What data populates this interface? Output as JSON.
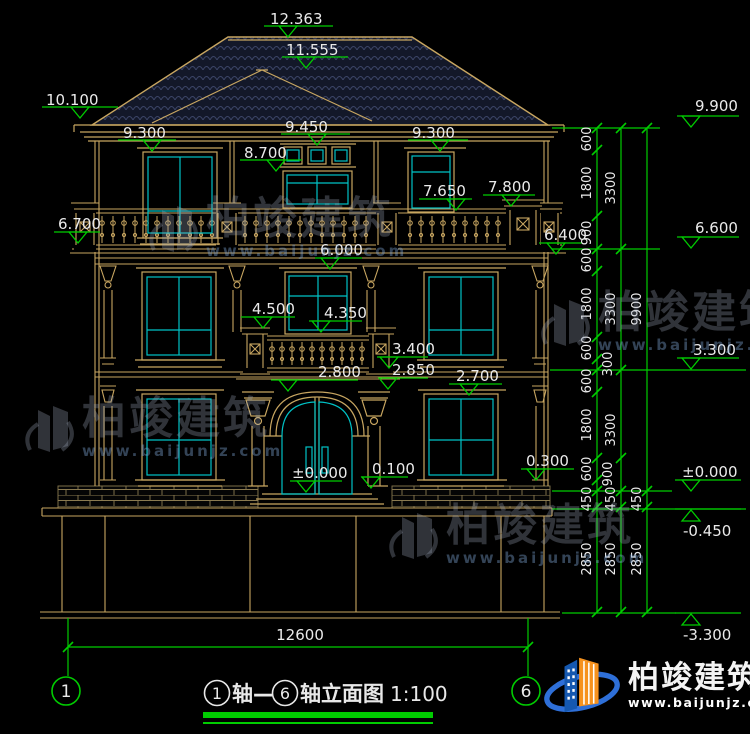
{
  "drawing": {
    "colors": {
      "line": "#c8a661",
      "glass": "#00c2c6",
      "dim": "#00cc00",
      "text": "#eaeaea",
      "roof_bg": "#131829",
      "roof_tile": "#3b4466"
    },
    "title": {
      "axis_a": "1",
      "joiner": "轴—",
      "axis_b": "6",
      "suffix": "轴立面图",
      "scale": "1:100"
    },
    "axis_bubbles": [
      {
        "label": "1",
        "cx": 66,
        "cy": 691,
        "lx": 68
      },
      {
        "label": "6",
        "cx": 526,
        "cy": 691,
        "lx": 528
      }
    ],
    "levels": [
      {
        "label": "12.363",
        "tx": 270,
        "ty": 12,
        "x1": 264,
        "x2": 333,
        "ly": 26,
        "cx": 288,
        "dir": "down"
      },
      {
        "label": "11.555",
        "tx": 286,
        "ty": 43,
        "x1": 282,
        "x2": 348,
        "ly": 57,
        "cx": 306,
        "dir": "down"
      },
      {
        "label": "10.100",
        "tx": 46,
        "ty": 93,
        "x1": 42,
        "x2": 118,
        "ly": 107,
        "cx": 80,
        "dir": "down"
      },
      {
        "label": "9.300",
        "tx": 123,
        "ty": 126,
        "x1": 118,
        "x2": 176,
        "ly": 140,
        "cx": 152,
        "dir": "down"
      },
      {
        "label": "9.450",
        "tx": 285,
        "ty": 120,
        "x1": 281,
        "x2": 350,
        "ly": 134,
        "cx": 317,
        "dir": "down"
      },
      {
        "label": "9.300",
        "tx": 412,
        "ty": 126,
        "x1": 408,
        "x2": 468,
        "ly": 140,
        "cx": 440,
        "dir": "down"
      },
      {
        "label": "8.700",
        "tx": 244,
        "ty": 146,
        "x1": 240,
        "x2": 302,
        "ly": 160,
        "cx": 276,
        "dir": "down"
      },
      {
        "label": "7.650",
        "tx": 423,
        "ty": 184,
        "x1": 419,
        "x2": 472,
        "ly": 199,
        "cx": 456,
        "dir": "down"
      },
      {
        "label": "7.800",
        "tx": 488,
        "ty": 180,
        "x1": 483,
        "x2": 535,
        "ly": 195,
        "cx": 511,
        "dir": "down"
      },
      {
        "label": "6.700",
        "tx": 58,
        "ty": 217,
        "x1": 54,
        "x2": 100,
        "ly": 232,
        "cx": 78,
        "dir": "down"
      },
      {
        "label": "6.400",
        "tx": 544,
        "ty": 228,
        "x1": 539,
        "x2": 582,
        "ly": 243,
        "cx": 556,
        "dir": "down"
      },
      {
        "label": "6.000",
        "tx": 320,
        "ty": 243,
        "x1": 315,
        "x2": 362,
        "ly": 258,
        "cx": 330,
        "dir": "down"
      },
      {
        "label": "4.500",
        "tx": 252,
        "ty": 302,
        "x1": 241,
        "x2": 295,
        "ly": 317,
        "cx": 263,
        "dir": "down"
      },
      {
        "label": "4.350",
        "tx": 324,
        "ty": 306,
        "x1": 309,
        "x2": 362,
        "ly": 321,
        "cx": 321,
        "dir": "down"
      },
      {
        "label": "3.400",
        "tx": 392,
        "ty": 342,
        "x1": 377,
        "x2": 428,
        "ly": 357,
        "cx": 389,
        "dir": "down"
      },
      {
        "label": "2.850",
        "tx": 392,
        "ty": 363,
        "x1": 382,
        "x2": 428,
        "ly": 378,
        "cx": 388,
        "dir": "down"
      },
      {
        "label": "2.800",
        "tx": 318,
        "ty": 365,
        "x1": 271,
        "x2": 358,
        "ly": 380,
        "cx": 288,
        "dir": "down"
      },
      {
        "label": "2.700",
        "tx": 456,
        "ty": 369,
        "x1": 449,
        "x2": 502,
        "ly": 384,
        "cx": 469,
        "dir": "down"
      },
      {
        "label": "±0.000",
        "tx": 292,
        "ty": 466,
        "x1": 290,
        "x2": 342,
        "ly": 481,
        "cx": 306,
        "dir": "down"
      },
      {
        "label": "0.100",
        "tx": 372,
        "ty": 462,
        "x1": 361,
        "x2": 408,
        "ly": 477,
        "cx": 371,
        "dir": "down"
      },
      {
        "label": "0.300",
        "tx": 526,
        "ty": 454,
        "x1": 521,
        "x2": 574,
        "ly": 469,
        "cx": 536,
        "dir": "down"
      },
      {
        "label": "9.900",
        "tx": 695,
        "ty": 99,
        "x1": 677,
        "x2": 739,
        "ly": 116,
        "cx": 691,
        "dir": "down"
      },
      {
        "label": "6.600",
        "tx": 695,
        "ty": 221,
        "x1": 677,
        "x2": 739,
        "ly": 237,
        "cx": 691,
        "dir": "down"
      },
      {
        "label": "3.300",
        "tx": 693,
        "ty": 343,
        "x1": 677,
        "x2": 739,
        "ly": 358,
        "cx": 691,
        "dir": "down"
      },
      {
        "label": "±0.000",
        "tx": 682,
        "ty": 465,
        "x1": 675,
        "x2": 741,
        "ly": 480,
        "cx": 691,
        "dir": "down"
      },
      {
        "label": "-0.450",
        "tx": 683,
        "ty": 524,
        "x1": 675,
        "x2": 741,
        "ly": 509,
        "cx": 691,
        "dir": "up"
      },
      {
        "label": "-3.300",
        "tx": 683,
        "ty": 628,
        "x1": 675,
        "x2": 741,
        "ly": 613,
        "cx": 691,
        "dir": "up"
      }
    ],
    "dim_chain": {
      "columns": [
        {
          "x": 597,
          "ticks": [
            128,
            150,
            216,
            249,
            271,
            337,
            359,
            370,
            392,
            458,
            480,
            491,
            507,
            612
          ],
          "labels": [
            {
              "v": "600",
              "y": 139
            },
            {
              "v": "1800",
              "y": 183
            },
            {
              "v": "900",
              "y": 233
            },
            {
              "v": "600",
              "y": 260
            },
            {
              "v": "1800",
              "y": 304
            },
            {
              "v": "600",
              "y": 348
            },
            {
              "v": "600",
              "y": 381
            },
            {
              "v": "1800",
              "y": 425
            },
            {
              "v": "600",
              "y": 469
            },
            {
              "v": "450",
              "y": 499
            },
            {
              "v": "2850",
              "y": 559
            }
          ]
        },
        {
          "x": 621,
          "ticks": [
            128,
            249,
            370,
            458,
            491,
            507,
            612
          ],
          "labels": [
            {
              "v": "3300",
              "y": 188
            },
            {
              "v": "3300",
              "y": 309
            },
            {
              "v": "3300",
              "y": 430
            },
            {
              "v": "450",
              "y": 499
            },
            {
              "v": "2850",
              "y": 559
            }
          ]
        },
        {
          "x": 647,
          "ticks": [
            128,
            491,
            507,
            612
          ],
          "labels": [
            {
              "v": "9900",
              "y": 309
            },
            {
              "v": "450",
              "y": 499
            },
            {
              "v": "2850",
              "y": 559
            }
          ]
        }
      ],
      "floating_labels": [
        {
          "v": "300",
          "x": 612,
          "y": 364
        },
        {
          "v": "900",
          "x": 612,
          "y": 474
        }
      ]
    },
    "bottom_dim": {
      "label": "12600",
      "x1": 68,
      "x2": 528,
      "y": 647,
      "tx": 300,
      "ty": 640
    }
  },
  "watermarks": {
    "name": "柏竣建筑",
    "url": "www.baijunjz.com",
    "positions": [
      {
        "x": 146,
        "y": 196
      },
      {
        "x": 538,
        "y": 290
      },
      {
        "x": 22,
        "y": 396
      },
      {
        "x": 386,
        "y": 503
      }
    ]
  },
  "brand": {
    "name": "柏竣建筑",
    "url": "www.baijunjz.com"
  }
}
